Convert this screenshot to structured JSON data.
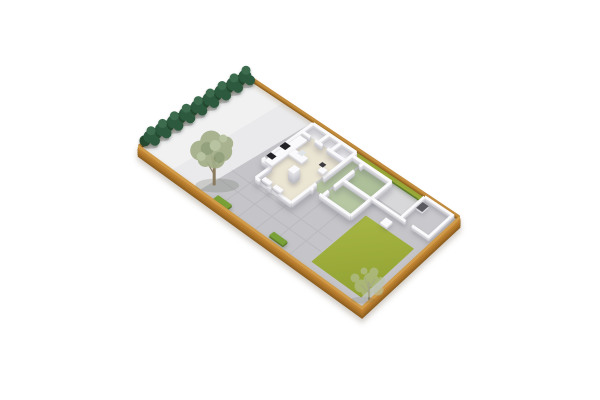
{
  "scene": {
    "type": "3d-isometric-floor-plan-render",
    "description": "Top-down isometric 3D render of a fenced rectangular garden plot containing a single-storey house with open roof, concrete yard, paved patio, lawn, garden shed, hedges and trees",
    "background": "#ffffff"
  },
  "colors": {
    "background": "#ffffff",
    "concrete": "#eaeaec",
    "concrete_light": "#f5f5f6",
    "paving": "#c5c5c9",
    "path": "#d8d8da",
    "lawn_light": "#a9b845",
    "lawn_dark": "#91a132",
    "hedge_strip": "#9db33d",
    "hedge_box": "#79a138",
    "fence_far": "#c28c3e",
    "fence_near": "#d19c4a",
    "wall": "#fafafc",
    "floor_rooms": "#f3f3f5",
    "floor_living": "#ebe5d3",
    "floor_hall": "#b5c5a0",
    "floor_bed1": "#adc099",
    "floor_bed2": "#b6c7a2",
    "floor_shed": "#c9c9cd",
    "furniture": "#fafafc",
    "sink_inset": "#e2e5e7",
    "sill": "#e9e9eb",
    "cooktop": "#232327",
    "appliance_dark": "#3c3c40",
    "shed_box": "#5a5a60",
    "trunk": "#8a7a5f",
    "canopy": "#a3ae88",
    "canopy_dark": "#8c9c74",
    "canopy_light": "#b4c09c",
    "wisp": "#b7c2a0",
    "shrub": "#2d5a3f",
    "shrub_dark": "#24492f",
    "shrub_light": "#3c6b4e"
  },
  "objects": {
    "fence": "wooden perimeter fence",
    "shrub_row": "row of 9 dark conifer shrubs along back-left fence",
    "concrete_yard": "light concrete yard",
    "paved_patio": "grey tiled patio around house",
    "house": "open-top house model: living/kitchen, three utility rooms, hallway, two green-floored bedrooms",
    "kitchen": "counter with black cooktop, sink unit, tall cabinet column",
    "lawn": "olive-green lawn",
    "walkway": "light path from house to garden shed",
    "shed": "white open-top garden shed in right corner",
    "trees": "large sage-green tree on paving edge, small wispy tree at bottom corner"
  }
}
